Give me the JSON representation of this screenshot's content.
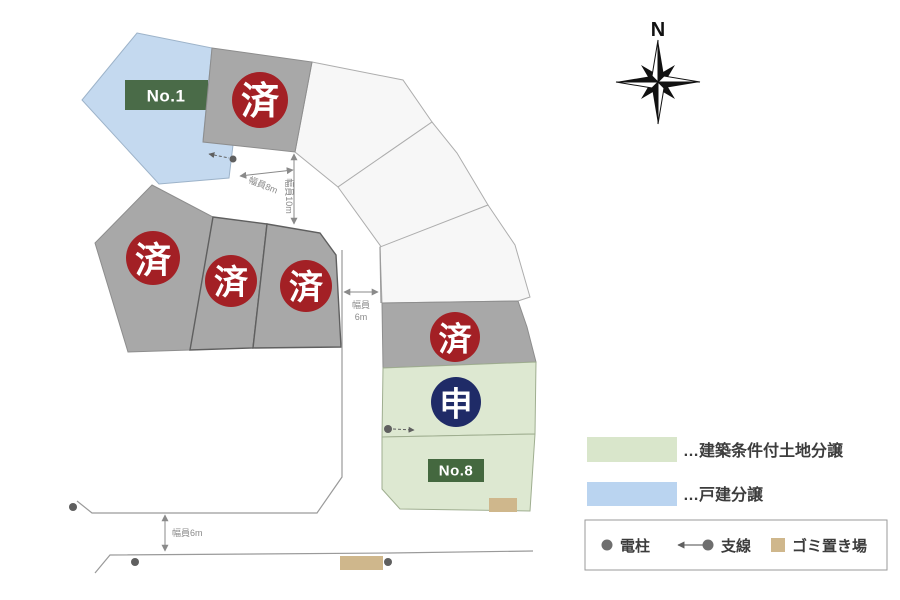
{
  "compass": {
    "north_label": "N"
  },
  "lots": {
    "no1_label": "No.1",
    "no8_label": "No.8",
    "sold_label": "済",
    "applied_label": "申"
  },
  "dimensions": {
    "road_8m": "幅員8m",
    "road_10m": "幅員10m",
    "road_6m_line1": "幅員",
    "road_6m_line2": "6m",
    "road_6m_bottom": "幅員6m"
  },
  "legend": {
    "green_label": "…建築条件付土地分譲",
    "blue_label": "…戸建分譲",
    "pole_label": "電柱",
    "wire_label": "支線",
    "garbage_label": "ゴミ置き場"
  },
  "colors": {
    "sold_circle": "#a32025",
    "applied_circle": "#1f2b67",
    "lot_gray": "#a8a8a8",
    "lot_blue": "#c4d9ef",
    "lot_green": "#dde8d1",
    "lot_white": "#f7f7f7",
    "name_plate_green": "#4a6b48",
    "garbage_tan": "#cfb78c"
  }
}
